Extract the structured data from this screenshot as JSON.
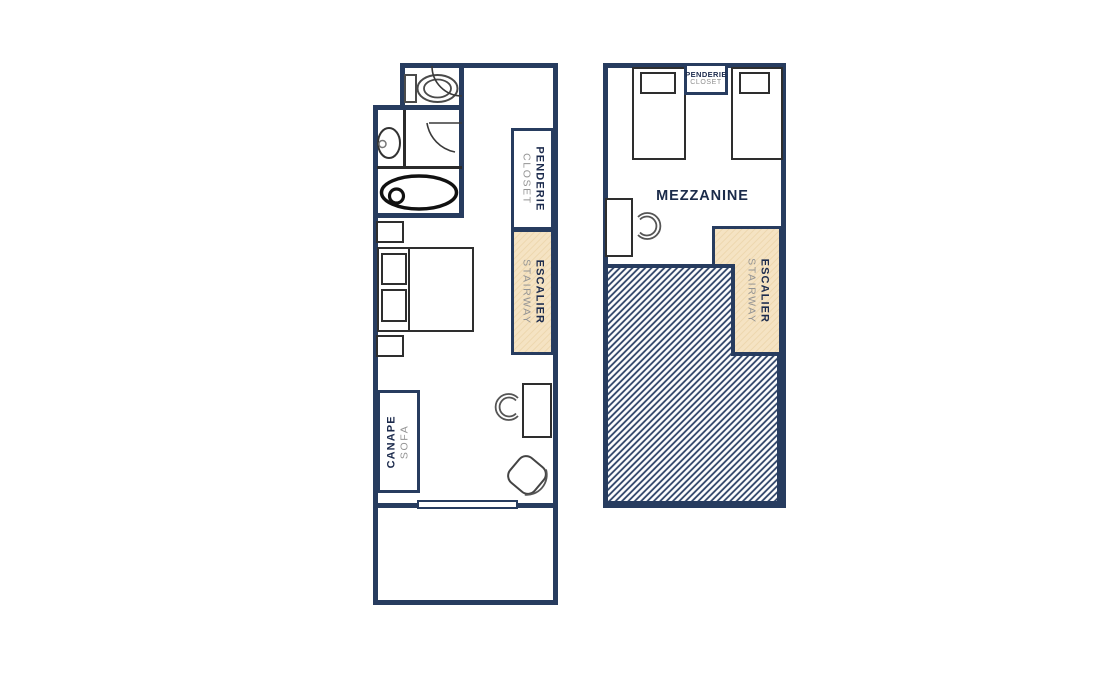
{
  "colors": {
    "wall_navy": "#273C5F",
    "fixture_black": "#2E2E2E",
    "stair_fill_beige": "#F5E3C3",
    "stair_hatch_line": "#EED8B0",
    "void_hatch_line": "#2C4166",
    "label_primary": "#1C2B4D",
    "label_secondary": "#949494"
  },
  "ground_floor": {
    "closet": {
      "primary": "PENDERIE",
      "secondary": "CLOSET"
    },
    "stairway": {
      "primary": "ESCALIER",
      "secondary": "STAIRWAY"
    },
    "sofa": {
      "primary": "CANAPE",
      "secondary": "SOFA"
    }
  },
  "mezzanine": {
    "title": "MEZZANINE",
    "closet": {
      "primary": "PENDERIE",
      "secondary": "CLOSET"
    },
    "stairway": {
      "primary": "ESCALIER",
      "secondary": "STAIRWAY"
    }
  }
}
